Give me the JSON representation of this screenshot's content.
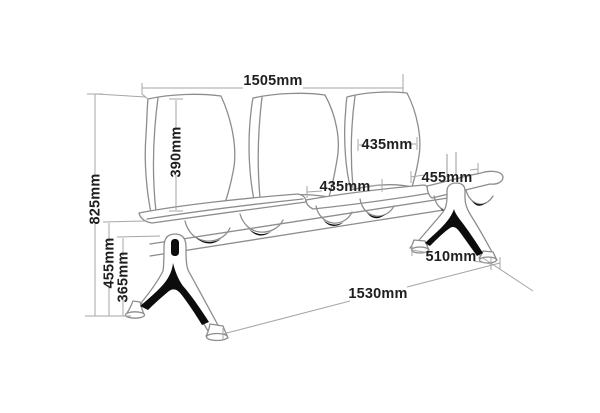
{
  "diagram": {
    "subject": "3-seat beam bench technical dimension drawing",
    "unit": "mm",
    "labels": {
      "total_width": "1505mm",
      "overall_height": "825mm",
      "seat_height": "455mm",
      "underseat_clearance": "365mm",
      "backrest_height": "390mm",
      "backrest_width": "435mm",
      "seat_width": "435mm",
      "seat_depth": "455mm",
      "foot_depth": "510mm",
      "base_length": "1530mm"
    },
    "values": {
      "total_width": 1505,
      "overall_height": 825,
      "seat_height": 455,
      "underseat_clearance": 365,
      "backrest_height": 390,
      "backrest_width": 435,
      "seat_width": 435,
      "seat_depth": 455,
      "foot_depth": 510,
      "base_length": 1530
    },
    "colors": {
      "background": "#ffffff",
      "line_art": "#8d8d8d",
      "dimension_lines": "#a6a6a6",
      "label_text": "#1f1f1f",
      "accent_black": "#0c0c0c"
    }
  }
}
